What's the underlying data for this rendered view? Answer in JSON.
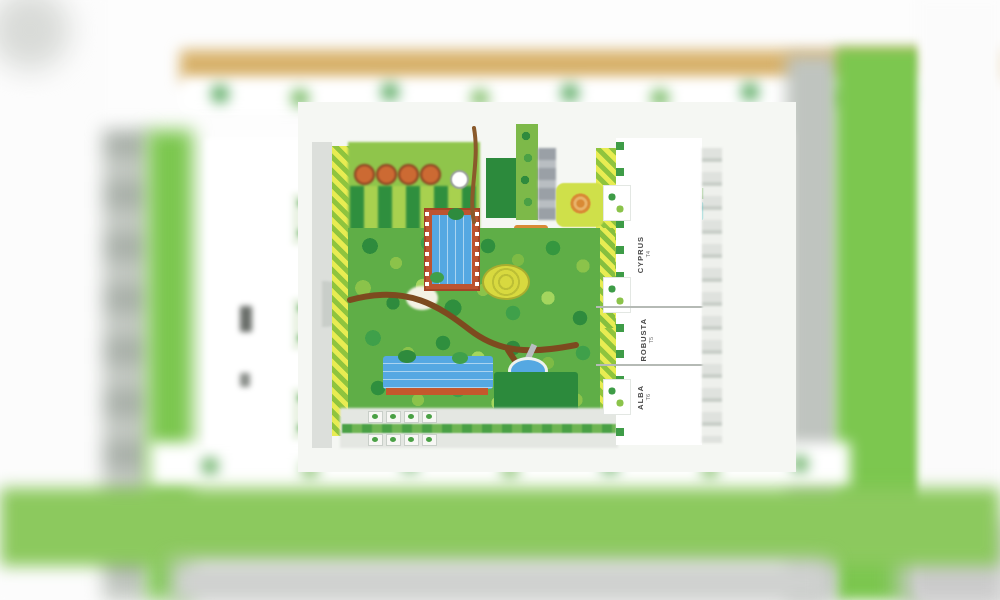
{
  "scene": {
    "type": "residential-masterplan-site-map",
    "description": "Blurred aerial master plan of a residential complex with a sharp central landscaped courtyard",
    "towers": [
      {
        "name": "CYPRUS",
        "code": "T4"
      },
      {
        "name": "ROBUSTA",
        "code": "T5"
      },
      {
        "name": "ALBA",
        "code": "T6"
      }
    ],
    "features": [
      "main-pool",
      "lap-pool",
      "kids-pool",
      "tennis-court",
      "central-garden",
      "formal-garden",
      "entry-water-feature",
      "playground",
      "spiral-lawn-mound",
      "winding-pergola-path",
      "perimeter-road",
      "parking-strip",
      "left-residential-block"
    ],
    "colors": {
      "lawn_green": "#7cc74f",
      "garden_green": "#5fae47",
      "hedge_dark_green": "#2f8f3e",
      "stripe_yellow": "#e8ec52",
      "pool_blue": "#55a8e2",
      "pool_deck_terracotta": "#bd5430",
      "tennis_teal": "#35b3a8",
      "court_yellow": "#d6e44c",
      "entry_water_cyan": "#49c4c9",
      "path_brown": "#7d4a1f",
      "road_tan": "#d8b26b",
      "road_gray": "#bfc4bf"
    }
  }
}
